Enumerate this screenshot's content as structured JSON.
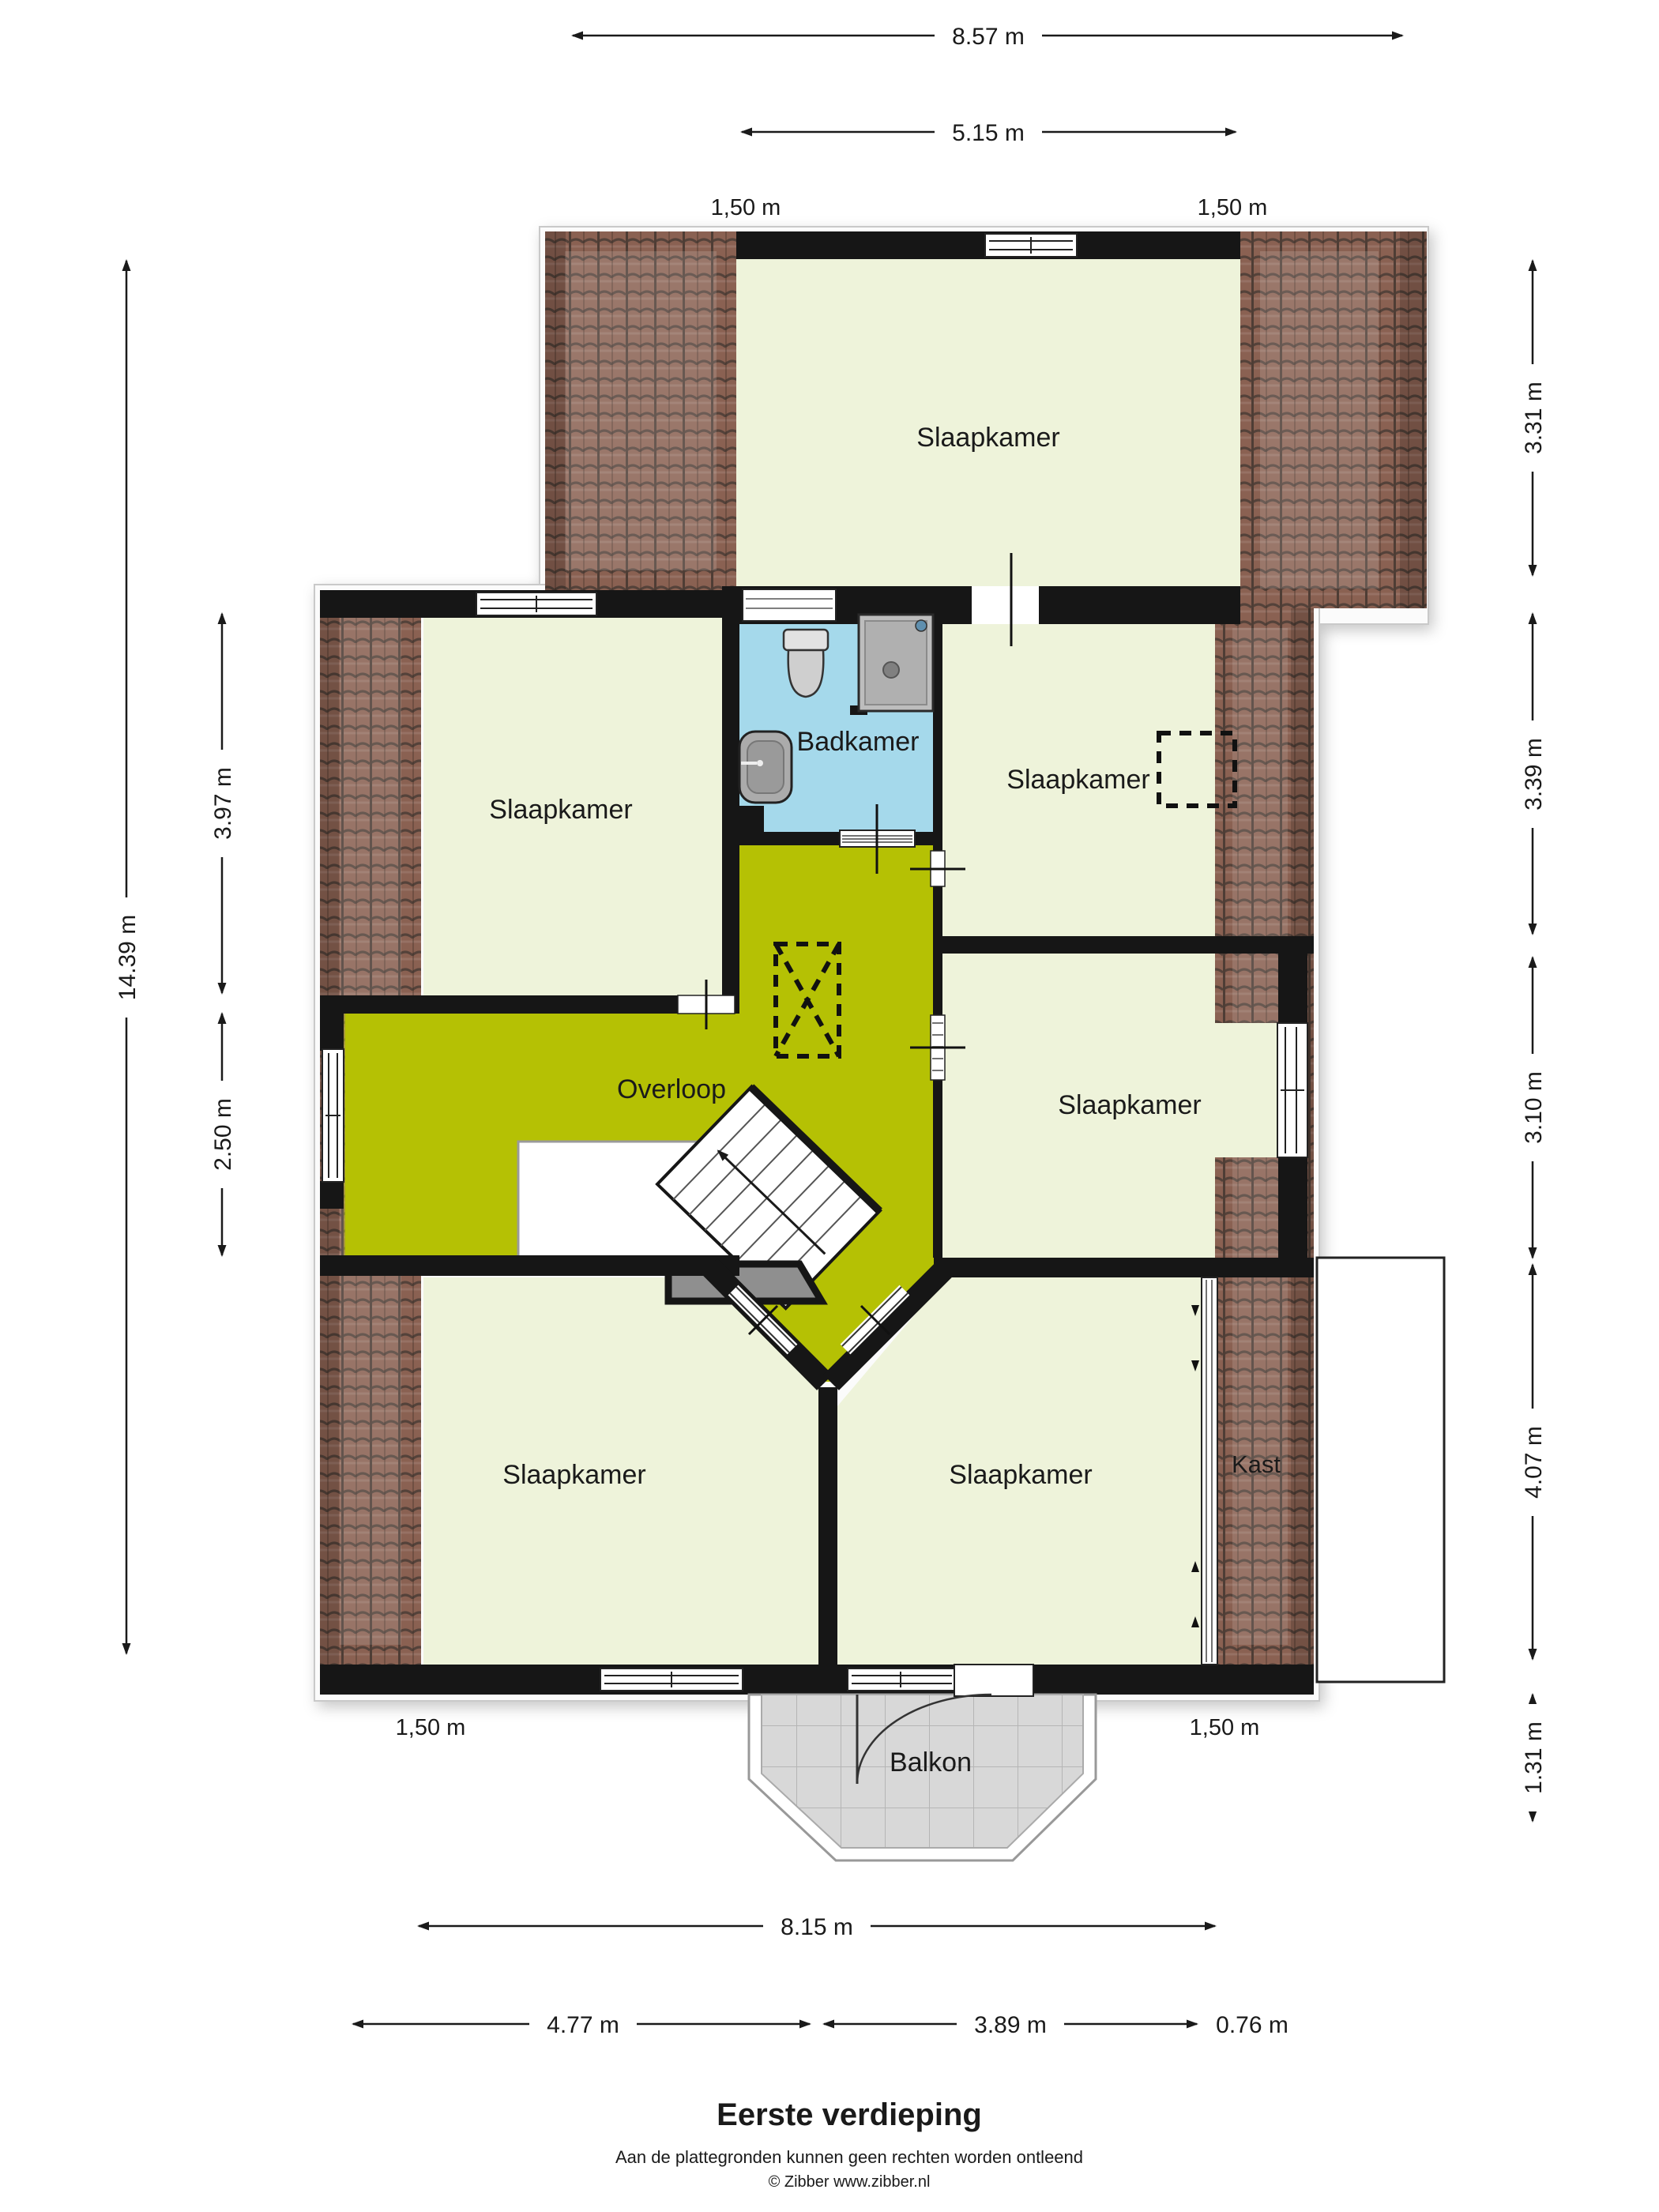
{
  "rooms": {
    "bedroom_top": "Slaapkamer",
    "bedroom_left": "Slaapkamer",
    "bathroom": "Badkamer",
    "bedroom_right_upper": "Slaapkamer",
    "landing": "Overloop",
    "bedroom_right_middle": "Slaapkamer",
    "bedroom_bottom_left": "Slaapkamer",
    "bedroom_bottom_middle": "Slaapkamer",
    "closet": "Kast",
    "balcony": "Balkon"
  },
  "dimensions": {
    "top_total": "8.57 m",
    "top_inner": "5.15 m",
    "eave_top_left": "1,50 m",
    "eave_top_right": "1,50 m",
    "right": [
      "3.31 m",
      "3.39 m",
      "3.10 m",
      "4.07 m",
      "1.31 m"
    ],
    "left_total": "14.39 m",
    "left_upper": "3.97 m",
    "left_lower": "2.50 m",
    "bottom_total": "8.15 m",
    "bottom_left": "4.77 m",
    "bottom_middle": "3.89 m",
    "bottom_right": "0.76 m",
    "eave_bottom_left": "1,50 m",
    "eave_bottom_right": "1,50 m"
  },
  "footer": {
    "title": "Eerste verdieping",
    "disclaimer": "Aan de plattegronden kunnen geen rechten worden ontleend",
    "copyright": "© Zibber www.zibber.nl"
  },
  "colors": {
    "floor": "#eef3da",
    "landing": "#b5c104",
    "bathroom": "#a5d9eb",
    "roof": "#8a6152",
    "wall": "#161616",
    "balcony_tile": "#d8d8d8"
  }
}
